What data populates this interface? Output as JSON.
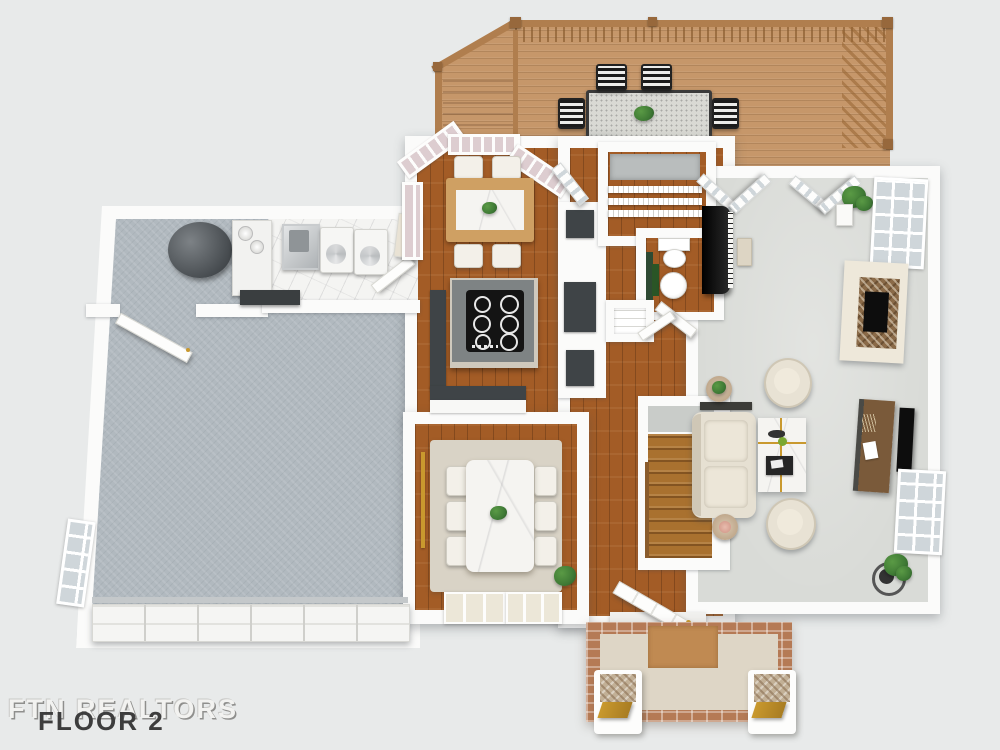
{
  "watermark": {
    "brand": "FTN REALTORS",
    "floor_label": "FLOOR 2"
  },
  "palette": {
    "background": "#e8eaea",
    "wall": "#fbfbfa",
    "deck_wood": "#c6976a",
    "deck_rail": "#b07e4e",
    "deck_rail_dark": "#97683c",
    "wood_floor": "#a35c26",
    "stair_wood": "#a9712f",
    "garage_floor": "#b1b9bf",
    "living_floor": "#d9dbd7",
    "laundry_tile": "#f4f4f2",
    "counter_dark": "#3f4447",
    "island_top": "#7e8384",
    "cooktop": "#141414",
    "rug": "#d9d3c6",
    "marble": "#f5f4f1",
    "chair_cream": "#e8e2d4",
    "sofa_cream": "#e6e0d2",
    "accent_green": "#2e4a33",
    "plant_green": "#3f7a35",
    "plant_dark": "#2a5526",
    "porch_brick": "#b57a55",
    "porch_floor": "#ded6c6",
    "porch_mat": "#c08a52",
    "column_stone": "#c2b096",
    "gold": "#c9992e",
    "tv_black": "#0d0d0d",
    "console_wood": "#7a5a3a",
    "glass": "#cfd6da",
    "glass_pink": "#ddcdd0",
    "text_dark": "#3d3d3d",
    "text_light": "#f2f2f0"
  }
}
